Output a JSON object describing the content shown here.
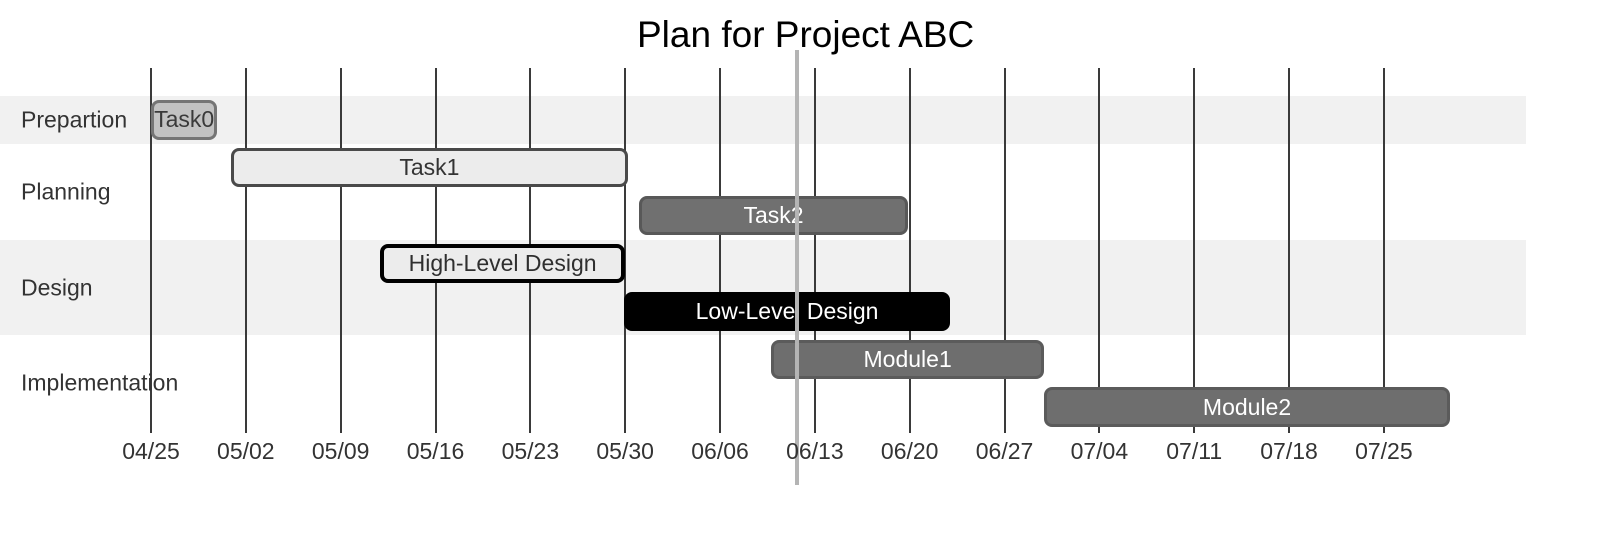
{
  "title": "Plan for Project ABC",
  "colors": {
    "background": "#ffffff",
    "section_band": "#f1f1f1",
    "gridline": "#3a3a3a",
    "axis_text": "#333333",
    "section_text": "#333333",
    "title_text": "#000000",
    "today_line": "#b4b4b4"
  },
  "axis": {
    "tick_labels": [
      "04/25",
      "05/02",
      "05/09",
      "05/16",
      "05/23",
      "05/30",
      "06/06",
      "06/13",
      "06/20",
      "06/27",
      "07/04",
      "07/11",
      "07/18",
      "07/25"
    ],
    "tick_interval_days": 7
  },
  "sections": [
    {
      "label": "Prepartion",
      "rows": 1,
      "shaded": true
    },
    {
      "label": "Planning",
      "rows": 2,
      "shaded": false
    },
    {
      "label": "Design",
      "rows": 2,
      "shaded": true
    },
    {
      "label": "Implementation",
      "rows": 2,
      "shaded": false
    }
  ],
  "tasks": [
    {
      "name": "Task0",
      "section": "Prepartion",
      "row": 0,
      "start_day": 0,
      "end_day": 4.9,
      "start_date": "04/25",
      "end_date": "04/30",
      "fill": "#c2c2c2",
      "border": "#757575",
      "border_width": 3,
      "text_color": "#3a3a3a"
    },
    {
      "name": "Task1",
      "section": "Planning",
      "row": 1,
      "start_day": 5.9,
      "end_day": 35.2,
      "start_date": "05/01",
      "end_date": "05/30",
      "fill": "#ececec",
      "border": "#4a4a4a",
      "border_width": 3,
      "text_color": "#333333"
    },
    {
      "name": "Task2",
      "section": "Planning",
      "row": 2,
      "start_day": 36,
      "end_day": 55.9,
      "start_date": "05/31",
      "end_date": "06/20",
      "fill": "#707070",
      "border": "#585858",
      "border_width": 3,
      "text_color": "#ffffff"
    },
    {
      "name": "High-Level Design",
      "section": "Design",
      "row": 3,
      "start_day": 16.9,
      "end_day": 35,
      "start_date": "05/12",
      "end_date": "05/30",
      "fill": "#ececec",
      "border": "#000000",
      "border_width": 4,
      "text_color": "#2f2f2f"
    },
    {
      "name": "Low-Level Design",
      "section": "Design",
      "row": 4,
      "start_day": 34.9,
      "end_day": 59,
      "start_date": "05/30",
      "end_date": "06/23",
      "fill": "#000000",
      "border": "#000000",
      "border_width": 3,
      "text_color": "#ffffff"
    },
    {
      "name": "Module1",
      "section": "Implementation",
      "row": 5,
      "start_day": 45.8,
      "end_day": 65.9,
      "start_date": "06/10",
      "end_date": "06/30",
      "fill": "#6e6e6e",
      "border": "#5b5b5b",
      "border_width": 3,
      "text_color": "#ffffff"
    },
    {
      "name": "Module2",
      "section": "Implementation",
      "row": 6,
      "start_day": 65.9,
      "end_day": 95.9,
      "start_date": "06/30",
      "end_date": "07/30",
      "fill": "#6e6e6e",
      "border": "#5b5b5b",
      "border_width": 3,
      "text_color": "#ffffff"
    }
  ],
  "today_marker": {
    "day": 47.7,
    "approx_date": "06/12"
  },
  "chart_data": {
    "type": "gantt",
    "title": "Plan for Project ABC",
    "x_axis": {
      "start": "04/25",
      "end": "07/25",
      "tick_interval": "7 days",
      "tick_labels": [
        "04/25",
        "05/02",
        "05/09",
        "05/16",
        "05/23",
        "05/30",
        "06/06",
        "06/13",
        "06/20",
        "06/27",
        "07/04",
        "07/11",
        "07/18",
        "07/25"
      ]
    },
    "today_marker_date": "06/12",
    "legend": "none",
    "grid": "vertical weekly gridlines",
    "sections": [
      {
        "name": "Prepartion",
        "tasks": [
          {
            "name": "Task0",
            "start": "04/25",
            "end": "04/30"
          }
        ]
      },
      {
        "name": "Planning",
        "tasks": [
          {
            "name": "Task1",
            "start": "05/01",
            "end": "05/30"
          },
          {
            "name": "Task2",
            "start": "05/31",
            "end": "06/20"
          }
        ]
      },
      {
        "name": "Design",
        "tasks": [
          {
            "name": "High-Level Design",
            "start": "05/12",
            "end": "05/30"
          },
          {
            "name": "Low-Level Design",
            "start": "05/30",
            "end": "06/23"
          }
        ]
      },
      {
        "name": "Implementation",
        "tasks": [
          {
            "name": "Module1",
            "start": "06/10",
            "end": "06/30"
          },
          {
            "name": "Module2",
            "start": "06/30",
            "end": "07/30"
          }
        ]
      }
    ]
  }
}
